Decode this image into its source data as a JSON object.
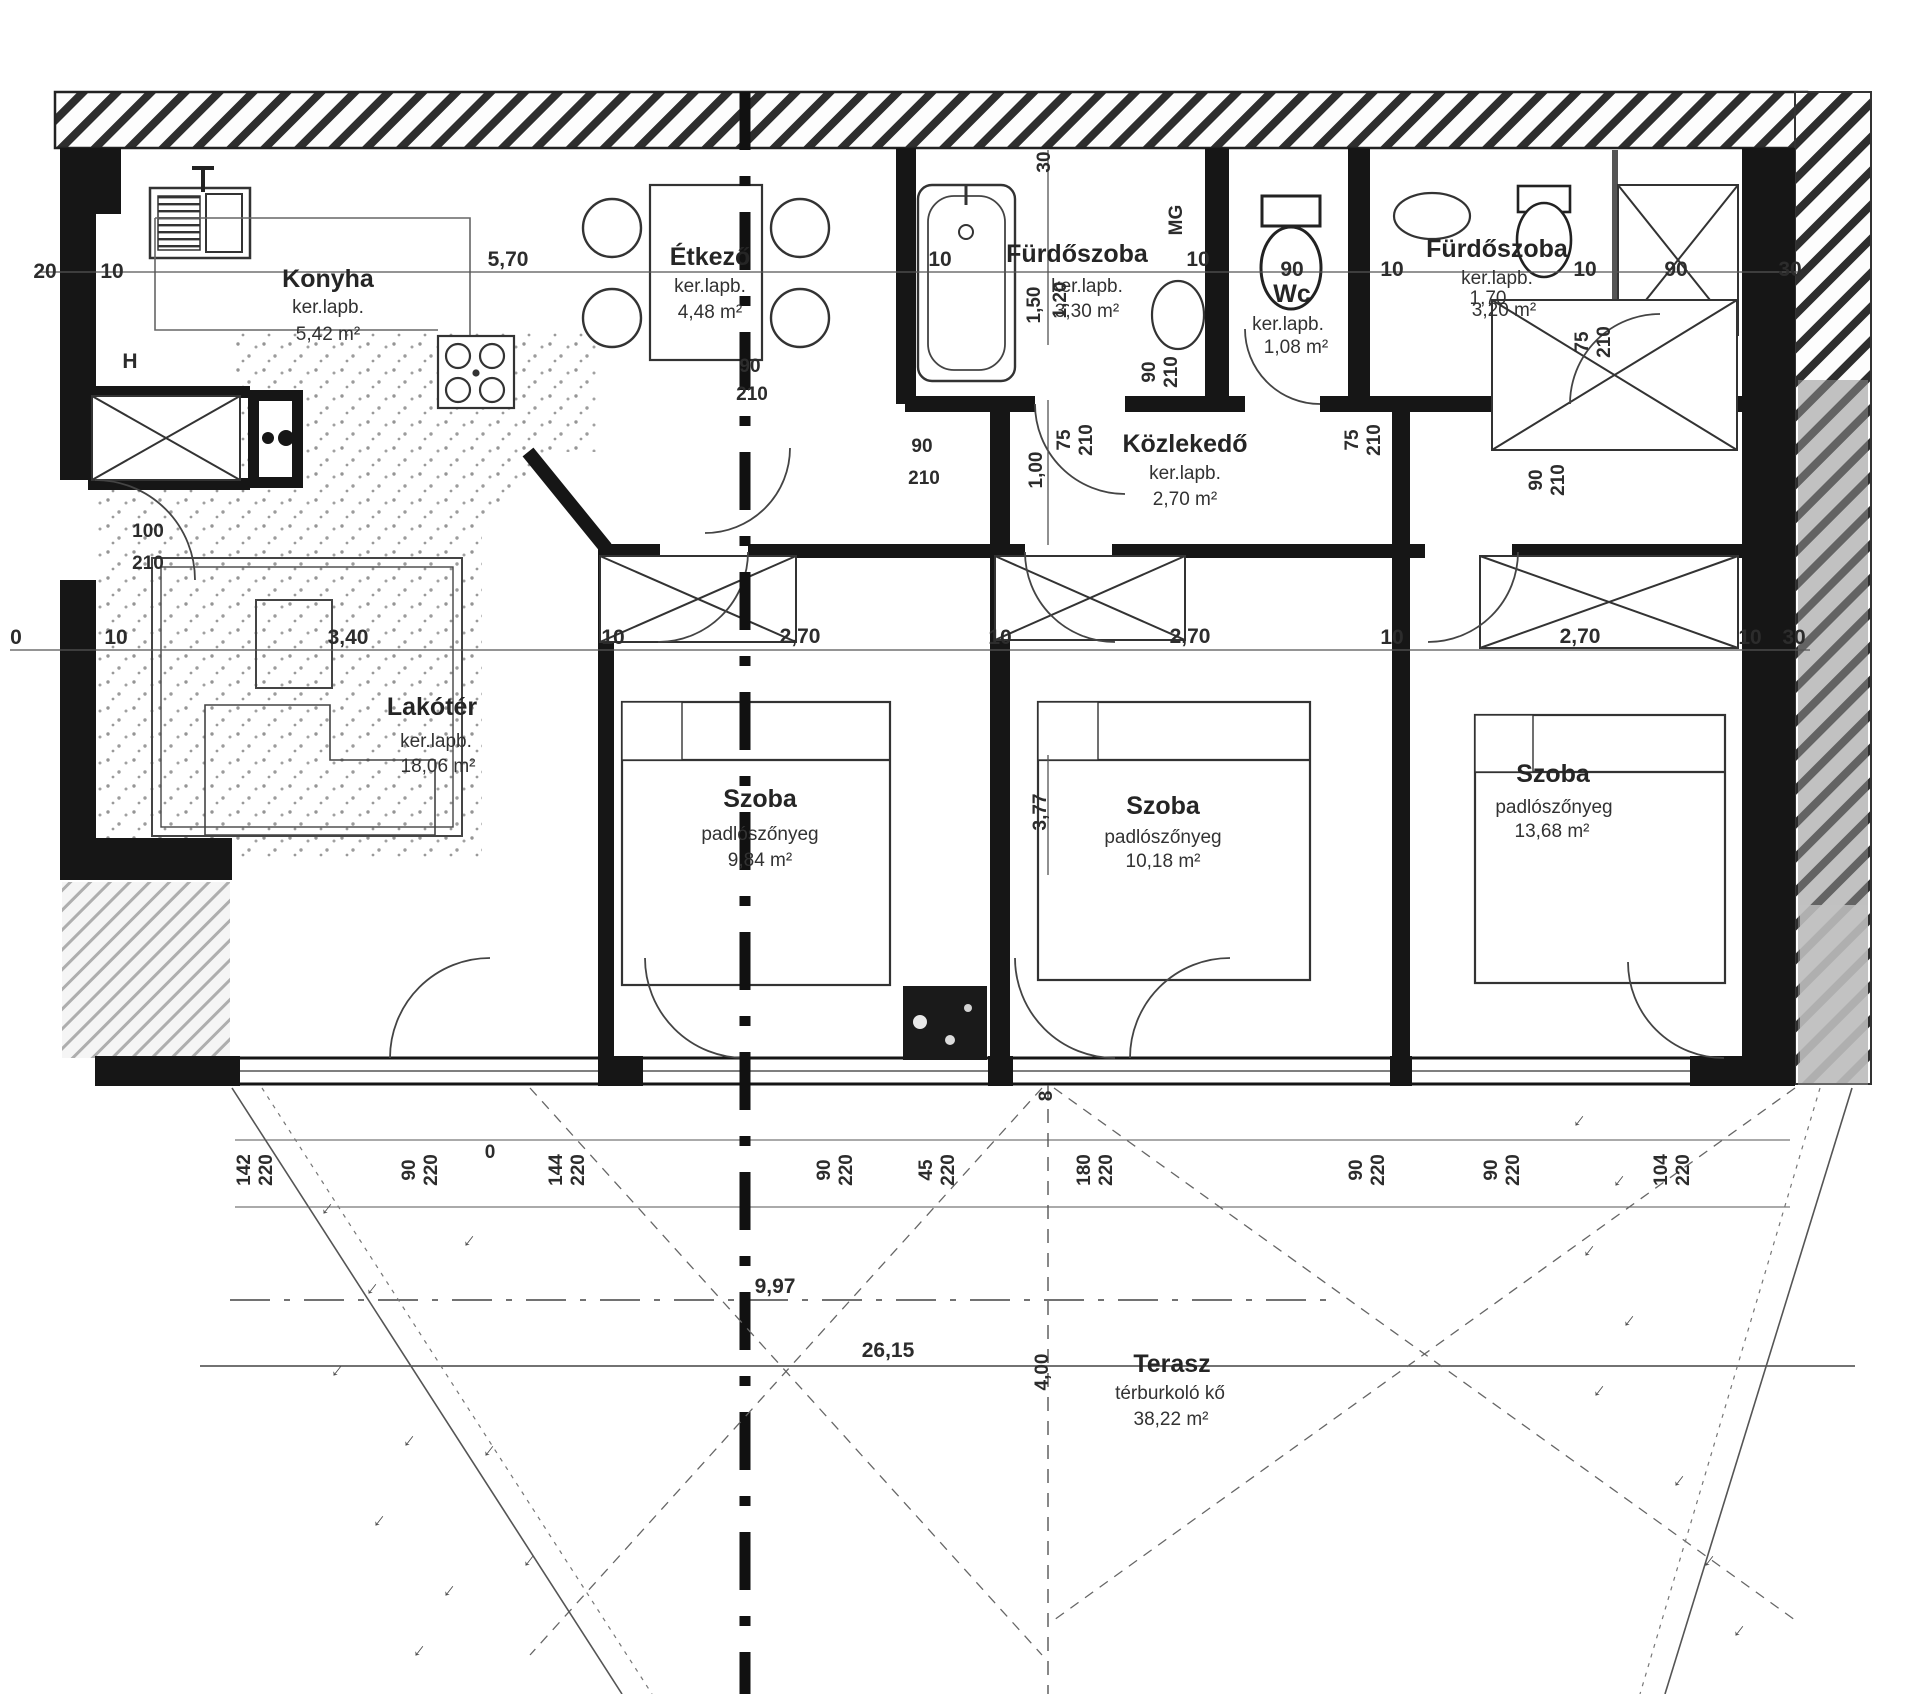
{
  "plan": {
    "rooms": [
      {
        "name": "Konyha",
        "material": "ker.lapb.",
        "area": "5,42 m²"
      },
      {
        "name": "Étkező",
        "material": "ker.lapb.",
        "area": "4,48 m²"
      },
      {
        "name": "Fürdőszoba",
        "material": "ker.lapb.",
        "area": "3,30 m²"
      },
      {
        "name": "Wc",
        "material": "ker.lapb.",
        "area": "1,08 m²"
      },
      {
        "name": "Fürdőszoba",
        "material": "ker.lapb.",
        "area": "3,20 m²"
      },
      {
        "name": "Közlekedő",
        "material": "ker.lapb.",
        "area": "2,70 m²"
      },
      {
        "name": "Lakótér",
        "material": "ker.lapb.",
        "area": "18,06 m²"
      },
      {
        "name": "Szoba",
        "material": "padlószőnyeg",
        "area": "9,84 m²"
      },
      {
        "name": "Szoba",
        "material": "padlószőnyeg",
        "area": "10,18 m²"
      },
      {
        "name": "Szoba",
        "material": "padlószőnyeg",
        "area": "13,68 m²"
      },
      {
        "name": "Terasz",
        "material": "térburkoló kő",
        "area": "38,22 m²"
      }
    ],
    "dims": [
      "20",
      "10",
      "5,70",
      "10",
      "30",
      "1,50",
      "1,20",
      "MG",
      "10",
      "90",
      "10",
      "10",
      "90",
      "30",
      "90",
      "210",
      "90",
      "210",
      "1,00",
      "75",
      "210",
      "75",
      "210",
      "90",
      "210",
      "75",
      "210",
      "90",
      "210",
      "100",
      "210",
      "0",
      "10",
      "3,40",
      "10",
      "2,70",
      "10",
      "2,70",
      "10",
      "2,70",
      "10",
      "30",
      "3,77",
      "142",
      "220",
      "90",
      "220",
      "0",
      "144",
      "220",
      "90",
      "220",
      "45",
      "220",
      "8",
      "180",
      "220",
      "90",
      "220",
      "90",
      "220",
      "104",
      "220",
      "9,97",
      "26,15",
      "4,00",
      "H",
      "1,70"
    ],
    "icons": {
      "grass": "↓"
    }
  }
}
